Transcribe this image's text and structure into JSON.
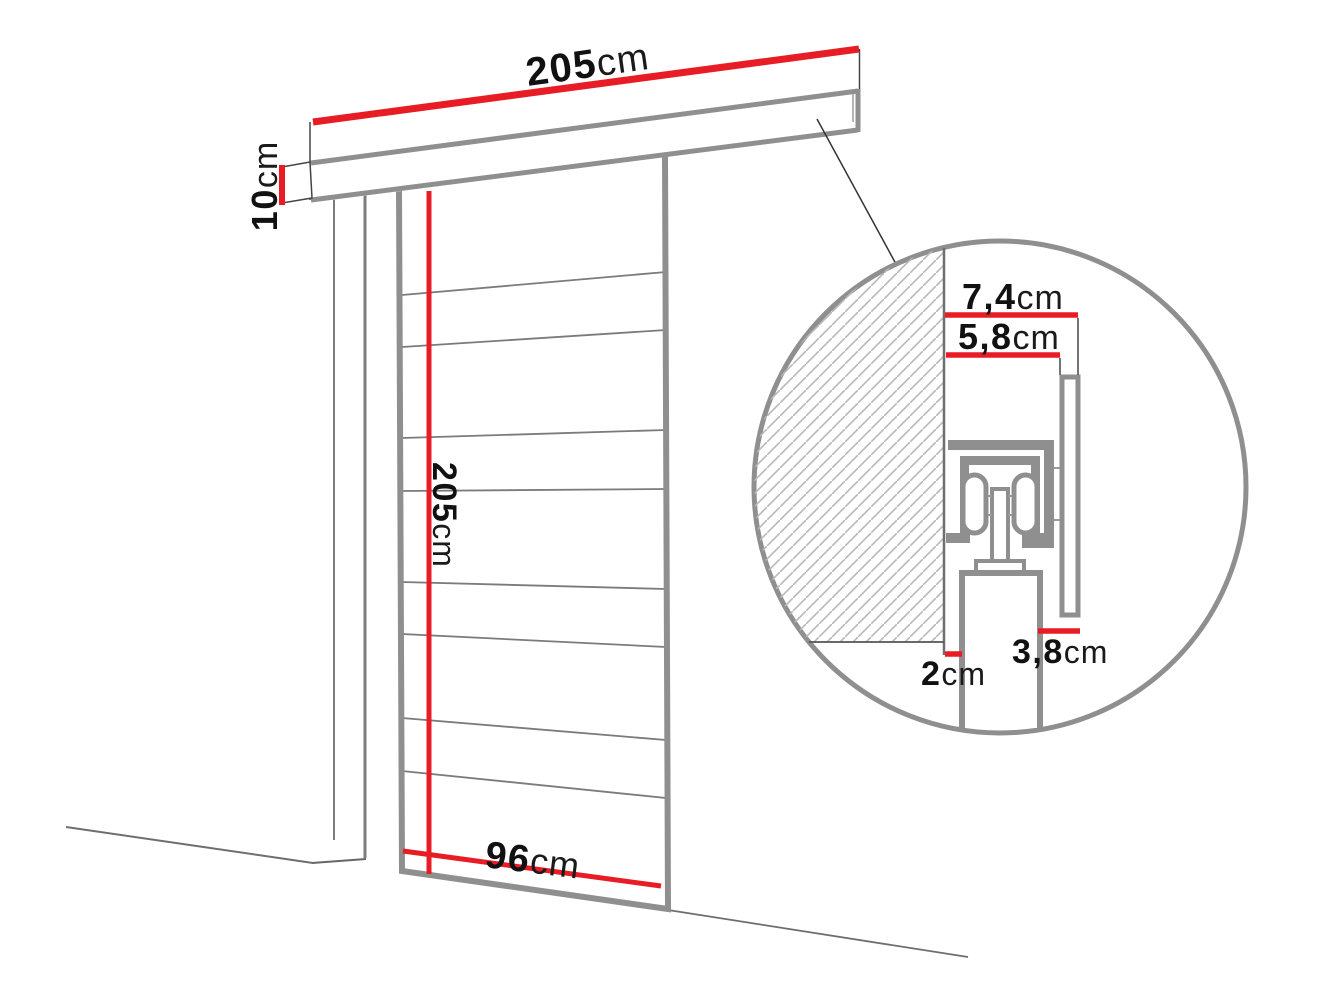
{
  "diagram": {
    "subject": "sliding-door-dimension-drawing",
    "units": "cm",
    "main": {
      "rail_length": {
        "value": "205",
        "unit": "cm"
      },
      "rail_height": {
        "value": "10",
        "unit": "cm"
      },
      "door_height": {
        "value": "205",
        "unit": "cm"
      },
      "door_width": {
        "value": "96",
        "unit": "cm"
      }
    },
    "detail": {
      "dim_top": {
        "value": "7,4",
        "unit": "cm"
      },
      "dim_inner": {
        "value": "5,8",
        "unit": "cm"
      },
      "dim_bottom": {
        "value": "3,8",
        "unit": "cm"
      },
      "dim_gap": {
        "value": "2",
        "unit": "cm"
      }
    },
    "colors": {
      "dimension_red": "#e81c24",
      "outline_gray": "#8f8f8f",
      "line_dark": "#444444",
      "hatch_gray": "#b8b8b8"
    }
  }
}
